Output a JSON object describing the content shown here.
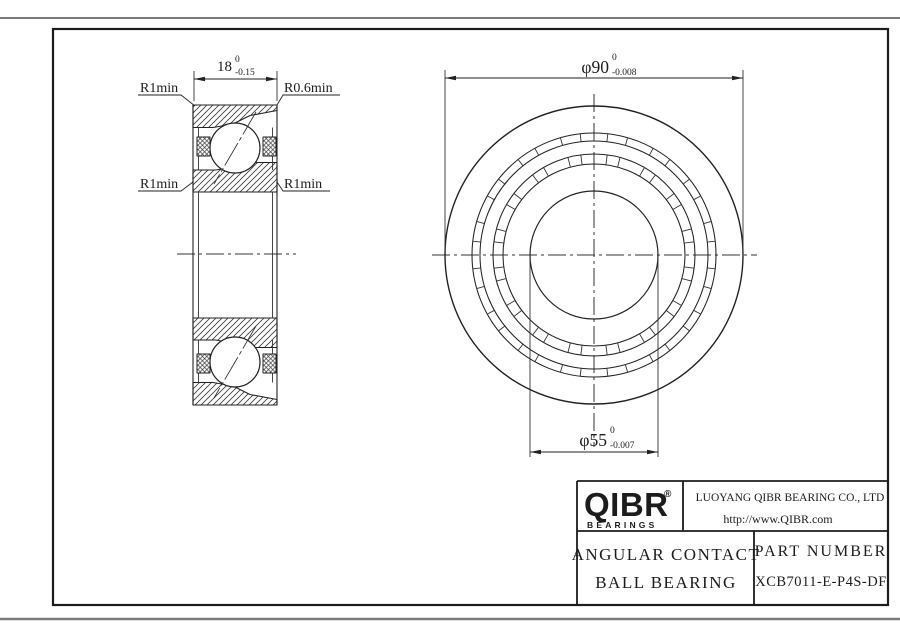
{
  "page": {
    "background": "#ffffff",
    "line_color": "#222222",
    "sheet_edge_color": "#7a7a7a"
  },
  "section_view": {
    "width_dim": {
      "value": "18",
      "tol_upper": "0",
      "tol_lower": "-0.15"
    },
    "label_top_left": "R1min",
    "label_top_right": "R0.6min",
    "label_mid_left": "R1min",
    "label_mid_right": "R1min"
  },
  "front_view": {
    "od_dim": {
      "value": "φ90",
      "tol_upper": "0",
      "tol_lower": "-0.008"
    },
    "bore_dim": {
      "value": "φ55",
      "tol_upper": "0",
      "tol_lower": "-0.007"
    }
  },
  "title_block": {
    "logo_text": "QIBR",
    "logo_registered": "®",
    "logo_subtext": "BEARINGS",
    "company": "LUOYANG QIBR BEARING CO., LTD",
    "website": "http://www.QIBR.com",
    "product_type_line1": "ANGULAR CONTACT",
    "product_type_line2": "BALL BEARING",
    "part_number_label": "PART NUMBER",
    "part_number": "XCB7011-E-P4S-DF"
  }
}
